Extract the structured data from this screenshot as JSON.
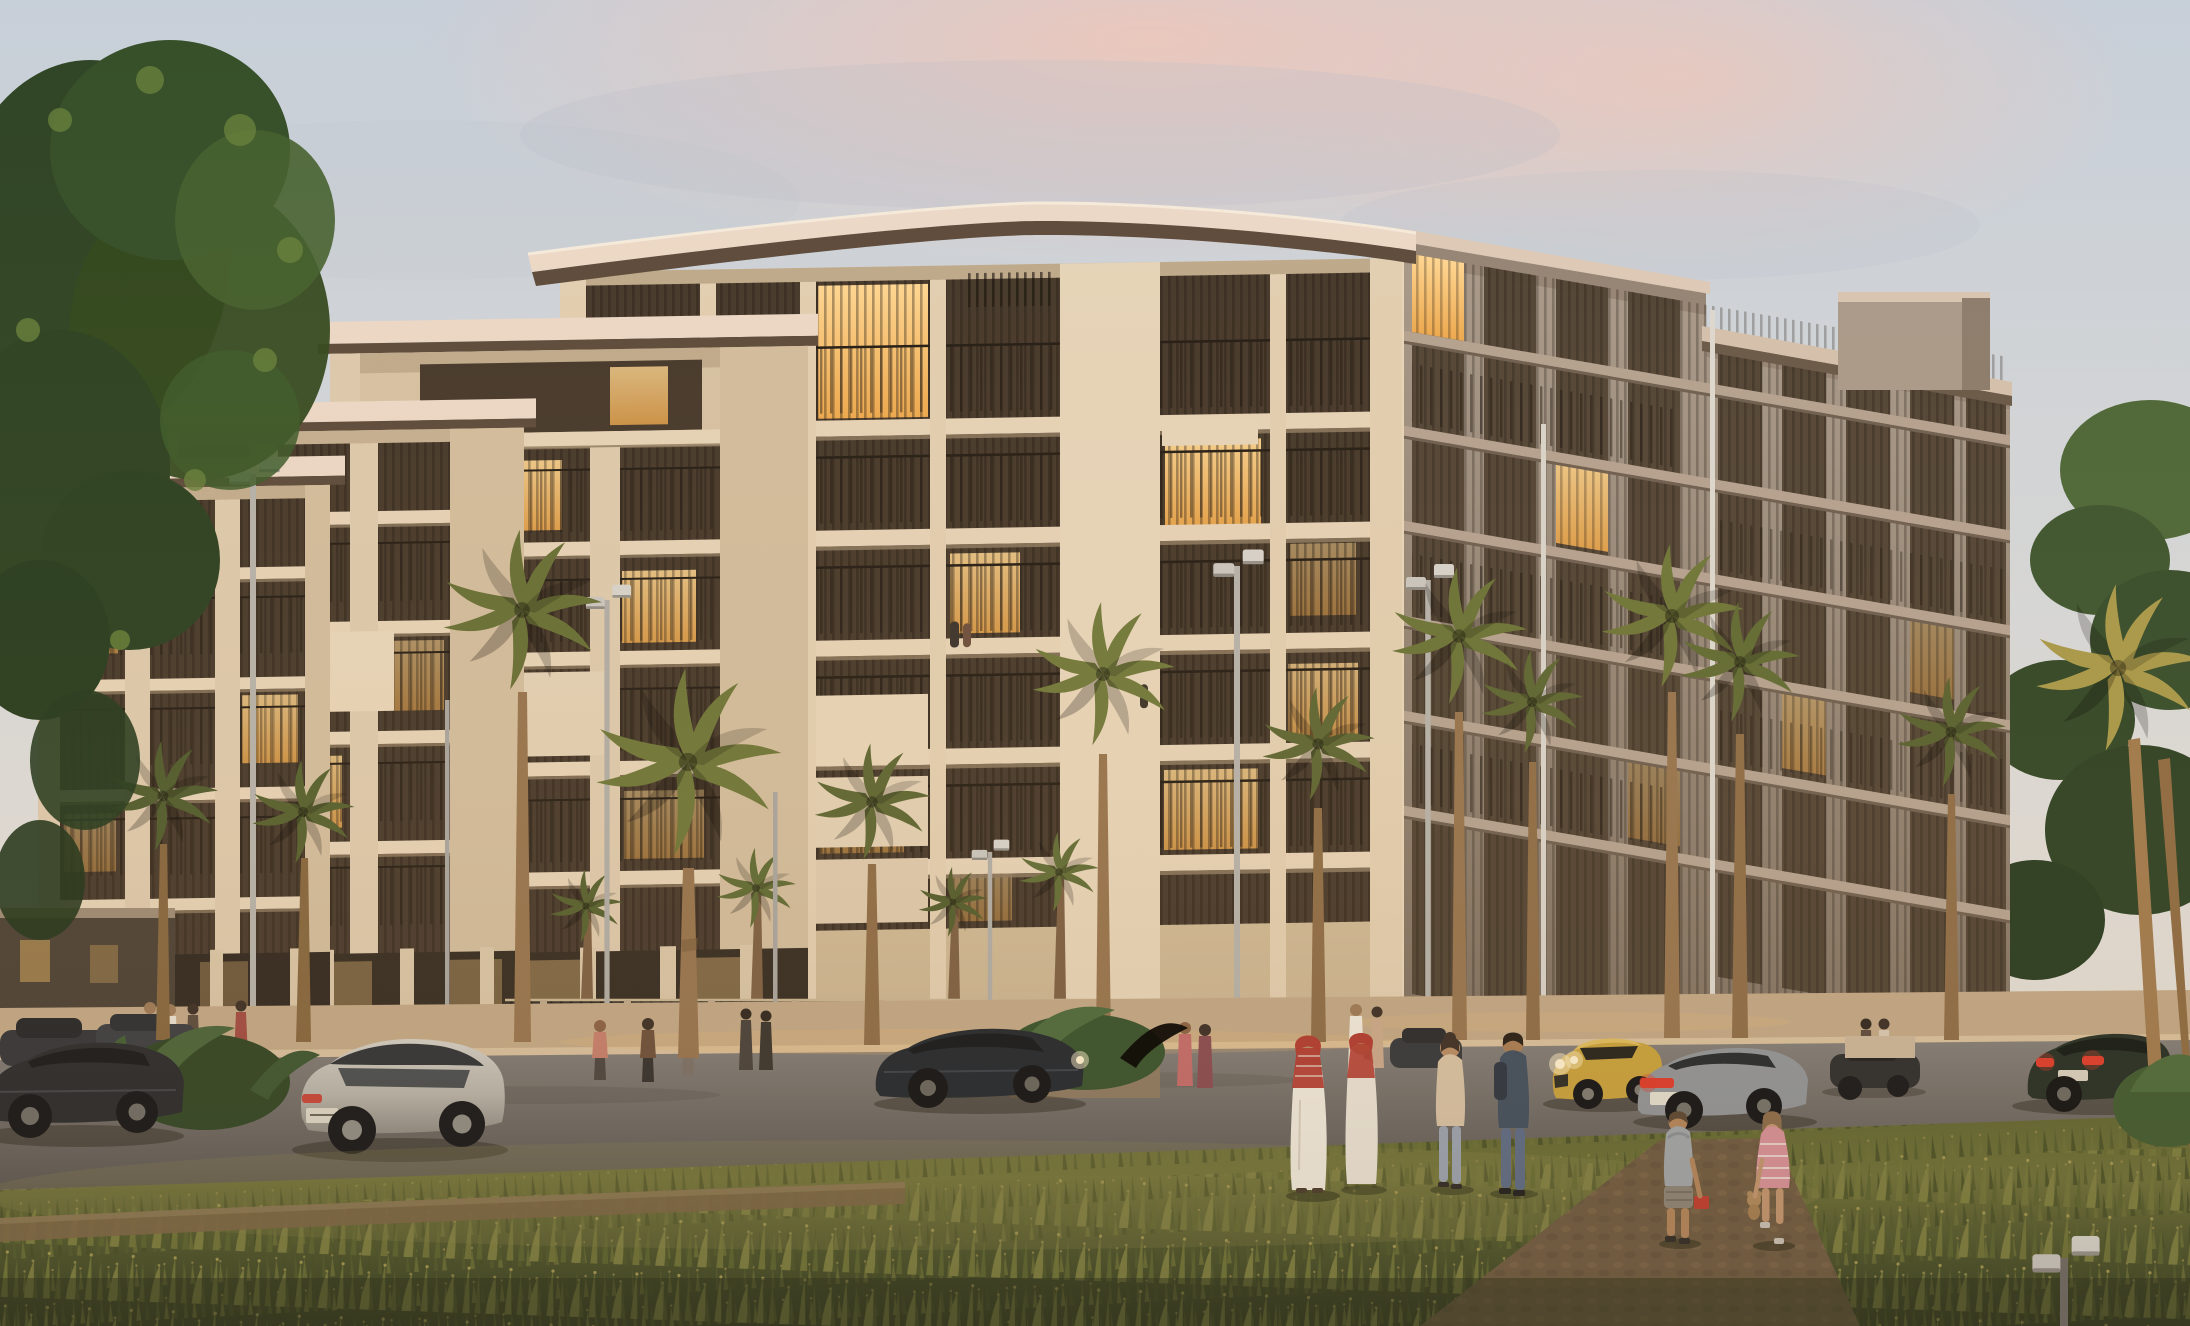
{
  "meta": {
    "kind": "architectural-rendering",
    "time_of_day": "dusk",
    "width_px": 2190,
    "height_px": 1326
  },
  "scene": {
    "title": "Residential complex at dusk",
    "description": "Photorealistic dusk rendering of a modern 5-7 storey residential complex with cream stucco piers, bronze vertical-louvre balconies and warm-lit interiors. Stepped terraced blocks descend to the left. A palm-lined street with silver street lamps runs in front of glowing ground-floor retail glazing; sedans and an SUV are parked or driving, pedestrians in white thobes with red keffiyehs and casual dress walk with children toward a wild-grass meadow in the foreground. A large green tree overhangs the upper-left corner and pink-lit clouds tint the pale sky.",
    "sign_note": "one tiny illegible entrance sign on the far-left block",
    "people": {
      "foreground": [
        "man in white thobe with red keffiyeh",
        "second man in white thobe",
        "woman in beige cardigan",
        "man in navy jacket with backpack",
        "boy in grey hoodie with red lunchbox",
        "girl in striped pink dress with teddy bear"
      ],
      "background_count": 14,
      "balcony_figures": 3
    },
    "vehicles": [
      "dark sedan (left, partly cropped)",
      "two parked dark cars (far left)",
      "silver SUV",
      "dark blue coupe (headlights on)",
      "yellow sports coupe (headlights on)",
      "grey sedan (red tail-lights)",
      "dark sedan (distant right)",
      "dark green fastback (red tail-lights)"
    ],
    "vegetation": [
      "large green tree upper-left",
      "twelve street palms",
      "four background palms behind louvre fence",
      "banana-leaf planters",
      "golden palm at right edge",
      "wild grass meadow"
    ],
    "street_furniture": [
      "six double-head street lamps",
      "two plain poles",
      "two tall white poles",
      "louvred privacy fence",
      "low white wall"
    ]
  },
  "palette": {
    "sky_top": "#c7cfd9",
    "sky_mid": "#d6d9dc",
    "sky_low": "#e6e0d8",
    "pink_cloud": "#eec7ba",
    "grey_cloud": "#b6bcc7",
    "tree_dark": "#2f4526",
    "tree_mid": "#45612f",
    "tree_light": "#67803c",
    "cream_light": "#e6d3b8",
    "cream": "#d8c4a5",
    "cream_shade": "#c2ab8a",
    "pier": "#e2cfb2",
    "face_right_top": "#a89a8c",
    "face_right_bot": "#7f7162",
    "bronze": "#46392c",
    "lit_bright": "#ffd793",
    "lit_warm": "#eda94f",
    "fascia": "#ecd9c8",
    "fascia_dark": "#5d4b3c",
    "glow": "#f3bd72",
    "storefront_dark": "#2c241d",
    "palm_olive": "#5c6633",
    "palm_light": "#70793c",
    "palm_gold": "#a89a4a",
    "palm_dark": "#4c572c",
    "trunk": "#96744f",
    "road": "#76716e",
    "road_dark": "#5a5652",
    "sidewalk": "#c3a988",
    "curb": "#d9c19e",
    "grass_hi": "#767a3e",
    "grass_mid": "#5a622f",
    "grass_dark": "#39411f",
    "dirt": "#7b6645",
    "path": "#6e5a41",
    "hedge": "#34302a",
    "car_dark": "#26282c",
    "car_silver": "#b7b3aa",
    "car_yellow": "#c9a23c",
    "car_green": "#222d25",
    "car_grey": "#90959a",
    "tail_red": "#e03a2c",
    "headlight": "#fff3d2",
    "thobe": "#f2ece0",
    "keffiyeh": "#b23a30",
    "skin": "#c99f7e",
    "lamp_metal": "#c9c6c0"
  }
}
